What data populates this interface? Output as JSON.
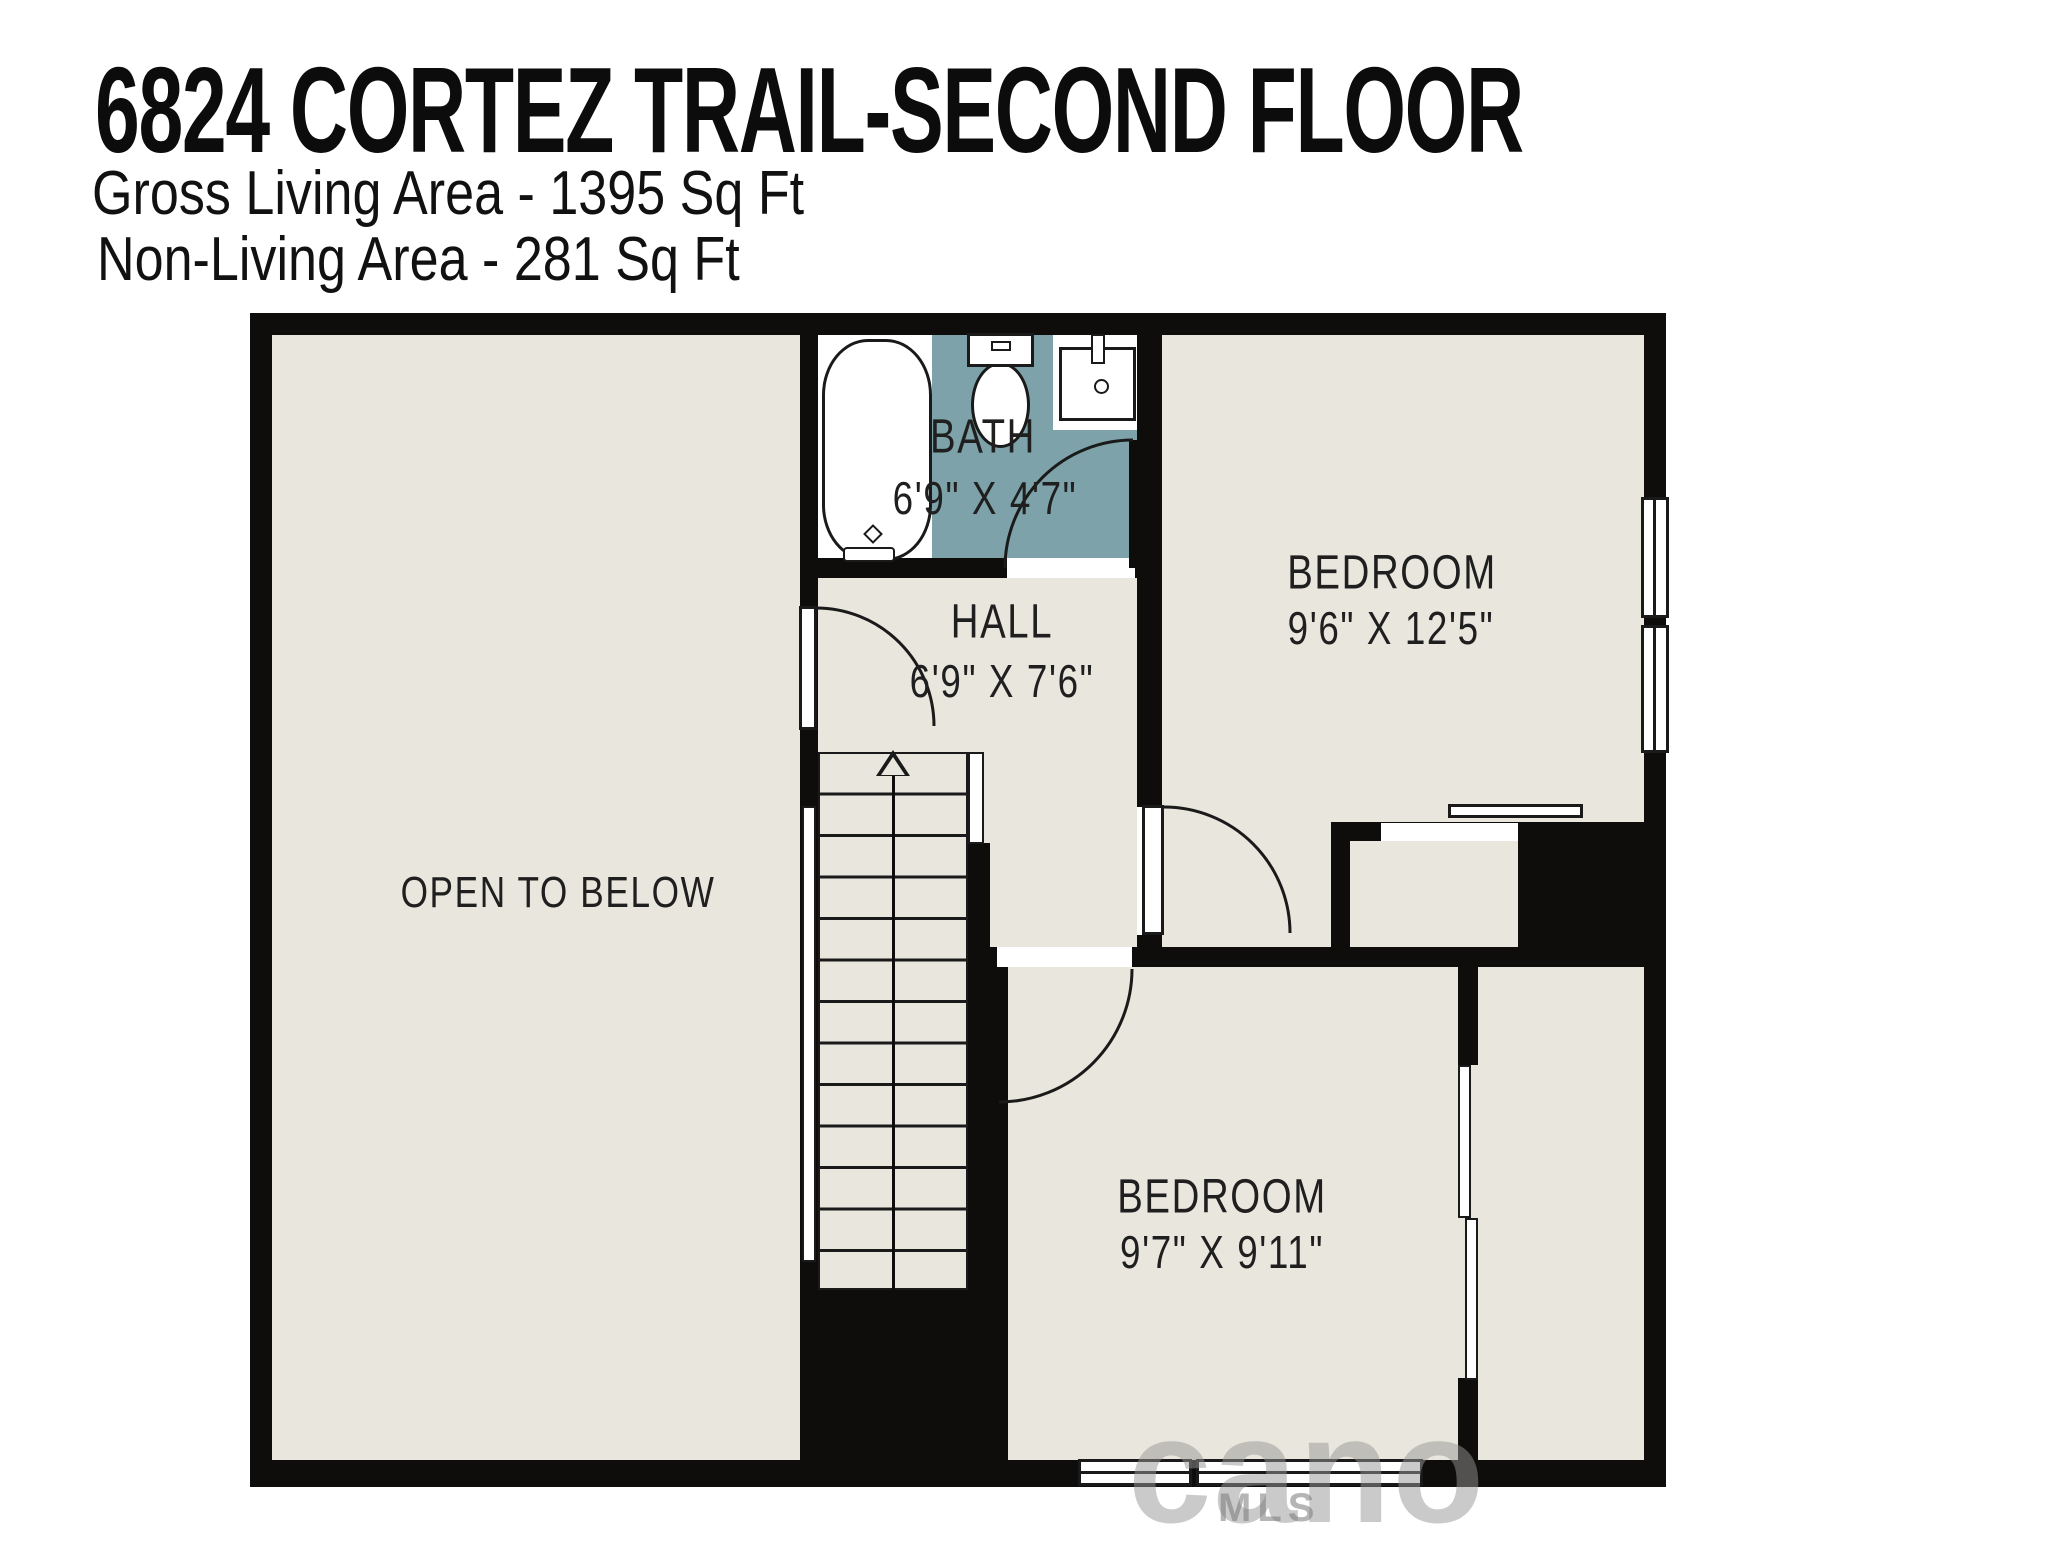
{
  "header": {
    "title": "6824 CORTEZ TRAIL-SECOND FLOOR",
    "gross_living_area": "Gross Living Area - 1395 Sq Ft",
    "non_living_area": "Non-Living Area - 281 Sq Ft"
  },
  "plan": {
    "rooms": {
      "open_to_below": {
        "label": "OPEN TO BELOW"
      },
      "bath": {
        "label": "BATH",
        "dims": "6'9\" X 4'7\""
      },
      "hall": {
        "label": "HALL",
        "dims": "6'9\" X 7'6\""
      },
      "bedroom_1": {
        "label": "BEDROOM",
        "dims": "9'6\" X 12'5\""
      },
      "bedroom_2": {
        "label": "BEDROOM",
        "dims": "9'7\" X 9'11\""
      }
    },
    "fixtures": [
      "bathtub",
      "toilet",
      "sink",
      "staircase-up"
    ],
    "stairs": {
      "direction": "up",
      "tread_count": 13
    }
  },
  "colors": {
    "bg": "#ffffff",
    "wall": "#0e0d0b",
    "floor": "#e9e6dd",
    "bath": "#7da2a9",
    "line": "#1a1a1a",
    "label": "#1f1f1f"
  },
  "watermark": {
    "logo": "cano",
    "label": "MLS"
  }
}
